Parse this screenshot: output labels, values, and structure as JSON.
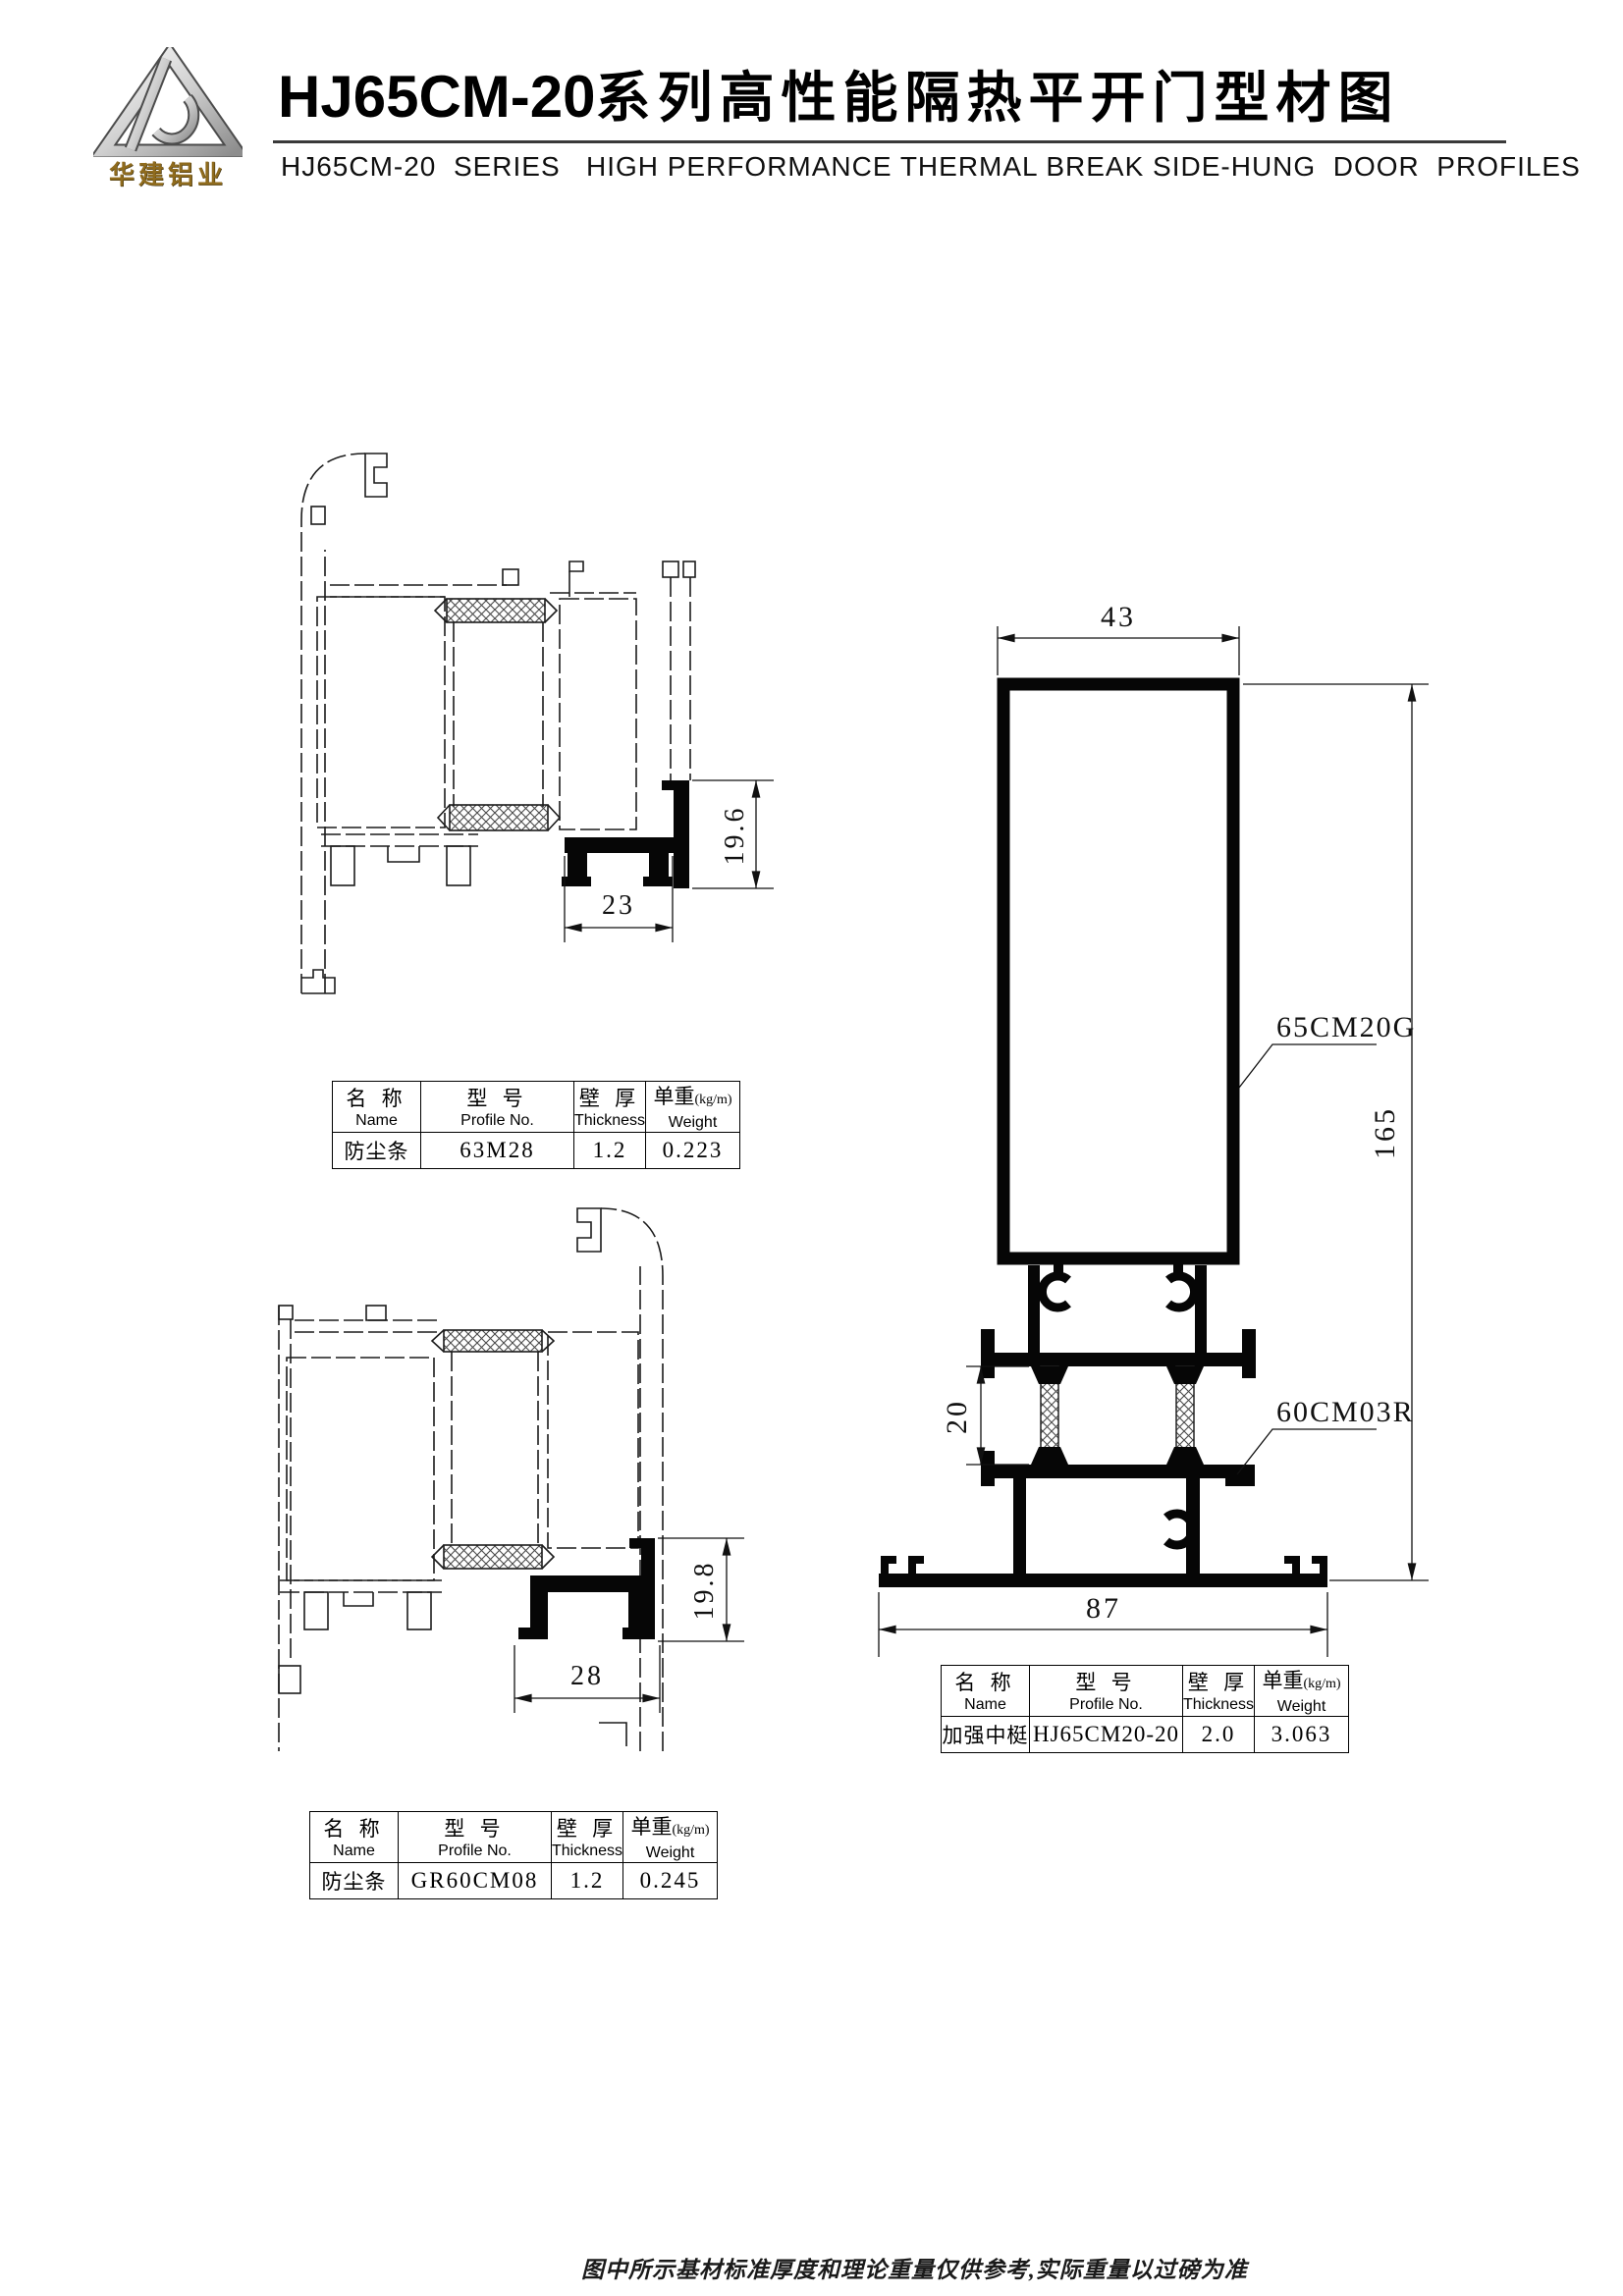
{
  "header": {
    "logo_name": "华建铝业",
    "title_model": "HJ65CM-20",
    "title_zh": "系列高性能隔热平开门型材图",
    "subtitle": "HJ65CM-20  SERIES   HIGH PERFORMANCE THERMAL BREAK SIDE-HUNG  DOOR  PROFILES"
  },
  "table_headers": {
    "name_zh": "名 称",
    "name_en": "Name",
    "profile_zh": "型 号",
    "profile_en": "Profile No.",
    "thickness_zh": "壁 厚",
    "thickness_en": "Thickness",
    "weight_zh": "单重",
    "weight_unit": "(kg/m)",
    "weight_en": "Weight"
  },
  "tables": [
    {
      "row": {
        "name": "防尘条",
        "profile": "63M28",
        "thickness": "1.2",
        "weight": "0.223"
      }
    },
    {
      "row": {
        "name": "加强中梃",
        "profile": "HJ65CM20-20",
        "thickness": "2.0",
        "weight": "3.063"
      }
    },
    {
      "row": {
        "name": "防尘条",
        "profile": "GR60CM08",
        "thickness": "1.2",
        "weight": "0.245"
      }
    }
  ],
  "drawings": {
    "top_left": {
      "dim_width": "23",
      "dim_height": "19.6"
    },
    "bottom_left": {
      "dim_width": "28",
      "dim_height": "19.8"
    },
    "main": {
      "dim_top": "43",
      "dim_height": "165",
      "dim_break": "20",
      "dim_bottom": "87",
      "label_upper": "65CM20G",
      "label_lower": "60CM03R"
    }
  },
  "footer": {
    "note": "图中所示基材标准厚度和理论重量仅供参考,实际重量以过磅为准"
  }
}
